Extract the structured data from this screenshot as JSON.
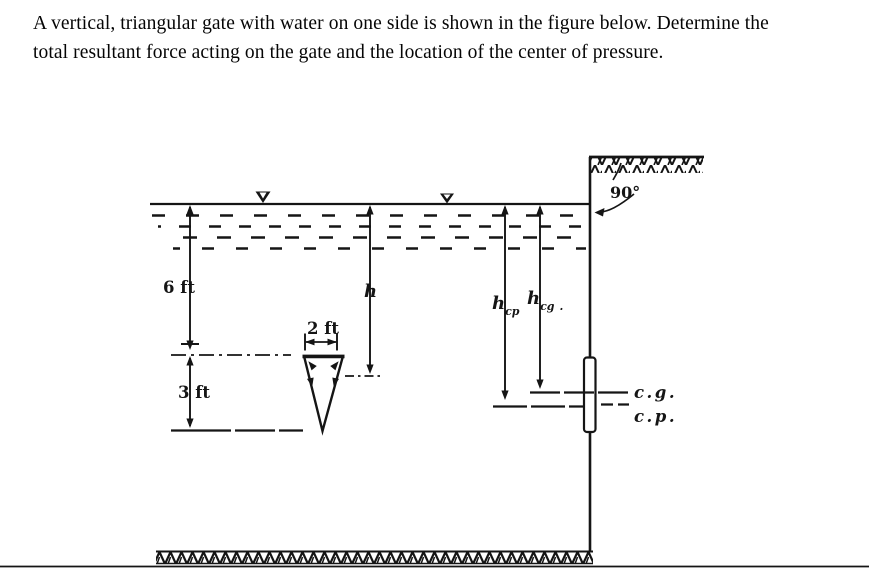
{
  "problem": {
    "statement_line1": "A vertical, triangular gate with water on one side is shown in the figure below. Determine the",
    "statement_line2": "total resultant force acting on the gate and the location of the center of pressure."
  },
  "figure": {
    "labels": {
      "depth_to_gate_top": "6 ft",
      "gate_height": "3 ft",
      "gate_top_width": "2 ft",
      "depth_to_centroid": "h",
      "h_cp_base": "h",
      "h_cp_sub": "cp",
      "h_cg_base": "h",
      "h_cg_sub": "cg",
      "h_cg_period": ".",
      "wall_angle": "90°",
      "center_of_gravity": "c.g.",
      "center_of_pressure": "c.p."
    },
    "colors": {
      "ink": "#151515",
      "page_line": "#b5b5b5"
    }
  }
}
